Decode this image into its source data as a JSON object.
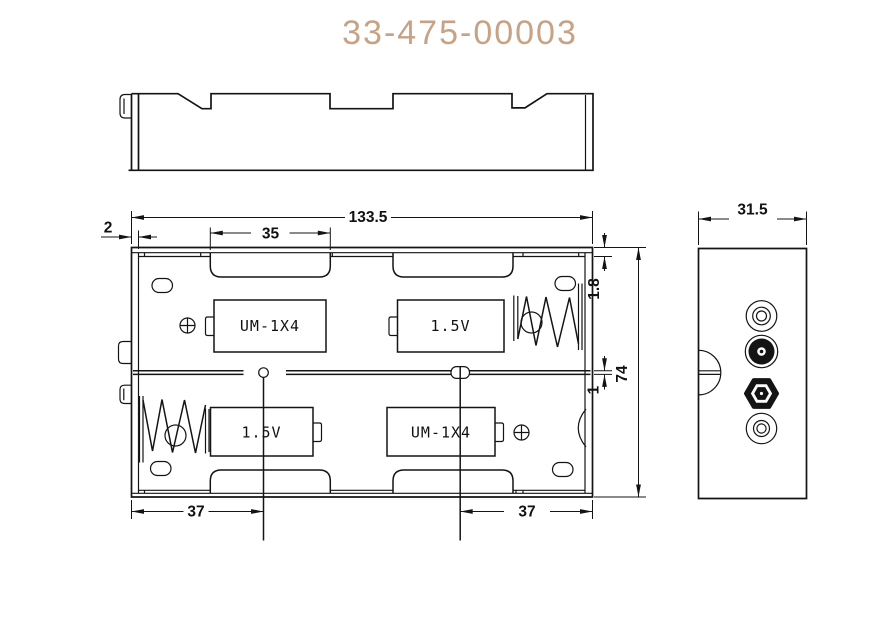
{
  "title": "33-475-00003",
  "colors": {
    "line": "#141414",
    "title": "#c7a284"
  },
  "front_view": {
    "slot_top_left_label": "UM-1X4",
    "slot_top_right_label": "1.5V",
    "slot_bottom_left_label": "1.5V",
    "slot_bottom_right_label": "UM-1X4"
  },
  "dimensions": {
    "overall_width": "133.5",
    "slot_width": "35",
    "edge_offset": "2",
    "rim_height": "1.8",
    "overall_height": "74",
    "divider_thickness": "1",
    "terminal_pitch_left": "37",
    "terminal_pitch_right": "37",
    "side_width": "31.5"
  }
}
